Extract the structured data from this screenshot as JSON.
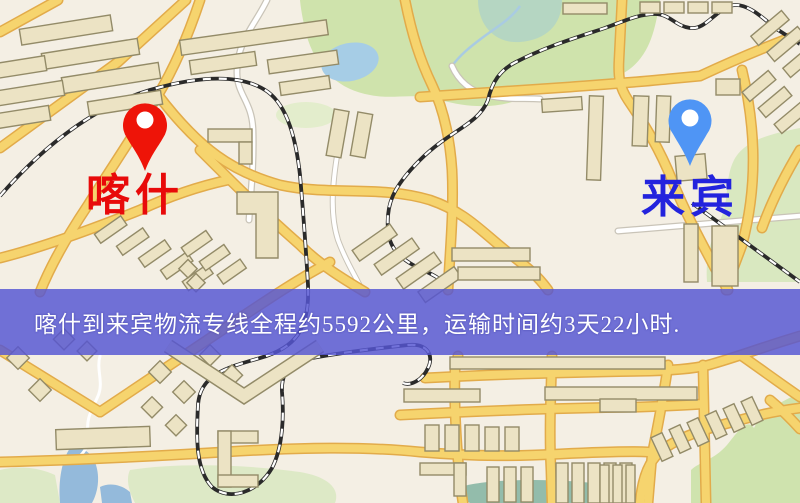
{
  "map": {
    "origin": {
      "name": "喀什",
      "pin_color": "#ee1408",
      "label_color": "#e80a0a"
    },
    "destination": {
      "name": "来宾",
      "pin_color": "#4f95f5",
      "label_color": "#2323dd"
    },
    "info_banner": {
      "text": "喀什到来宾物流专线全程约5592公里，运输时间约3天22小时.",
      "distance_km": "5592",
      "duration": "3天22小时",
      "background_color": "#5656d2",
      "text_color": "#ffffff"
    },
    "map_colors": {
      "background": "#f4efe4",
      "road": "#f6d46e",
      "road_casing": "#e2ab4a",
      "building": "#ece3c4",
      "building_outline": "#938b68",
      "park": "#cfe3ac",
      "water": "#a6cde6",
      "railway": "#2a2a2a"
    }
  }
}
